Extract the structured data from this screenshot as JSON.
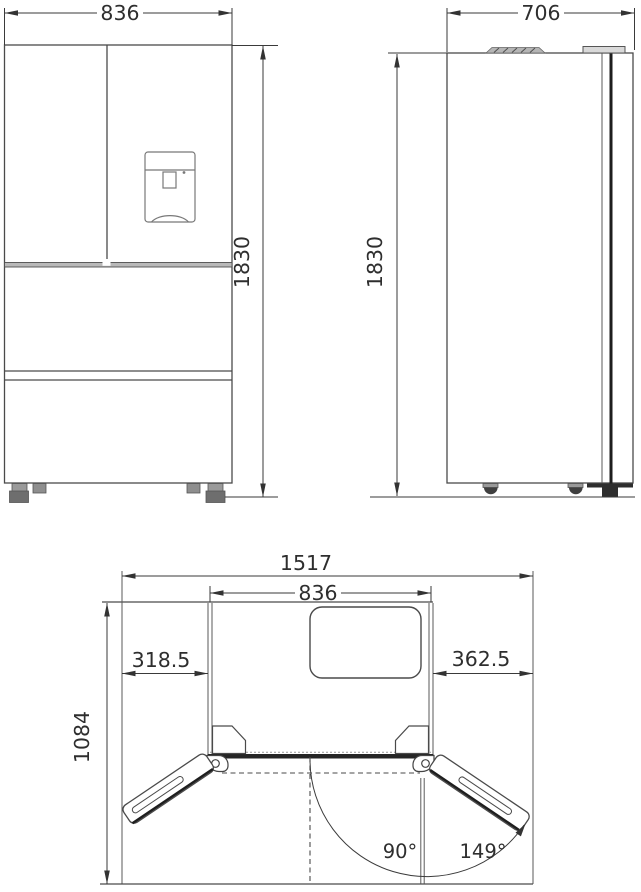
{
  "diagram": {
    "front": {
      "width": "836",
      "height": "1830"
    },
    "side": {
      "depth": "706",
      "height": "1830"
    },
    "top": {
      "total_width": "1517",
      "cabinet_width": "836",
      "left_clearance": "318.5",
      "right_clearance": "362.5",
      "open_depth": "1084",
      "angle_90": "90°",
      "angle_149": "149°"
    }
  }
}
